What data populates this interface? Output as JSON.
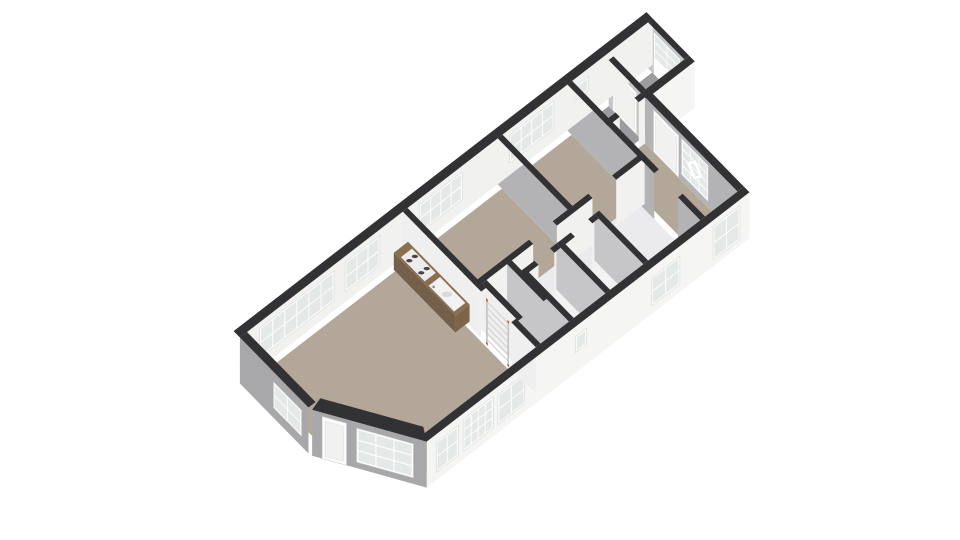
{
  "view": {
    "width": 960,
    "height": 540,
    "background": "#ffffff",
    "kind": "3d-floorplan-render"
  },
  "projection": {
    "origin": [
      247,
      378
    ],
    "axisU": [
      0.791,
      -0.611
    ],
    "axisV": [
      0.7,
      0.714
    ],
    "wallHeight": 46
  },
  "palette": {
    "cap": "#323234",
    "extWhite": "#f5f5f3",
    "intWhite": "#f1f1ef",
    "grayWall": "#b3b3b5",
    "midWall": "#c6c6c8",
    "extGray": "#a8a8aa",
    "lightWall": "#efefef",
    "beigeFloor": "#b3a79a",
    "grayFloor": "#9b9ba0",
    "hallFloor": "#ebebed",
    "whiteFloor": "#f2f2f2",
    "frame": "#fcfcfc",
    "frameEdge": "#cfcfcf",
    "glass": "#e4e8e6",
    "doorFill": "#fbfbfb",
    "doorPanel": "#f1f1ef",
    "counterTop": "#8a6e50",
    "counterWest": "#74604a",
    "counterSouth": "#7d6549",
    "cooktop": "#ececec",
    "burner": "#47474a",
    "sink": "#f2f2f2",
    "sinkBowl": "#d9d9d9",
    "faucet": "#8f8f92",
    "ladderRail": "#c6c6c9",
    "ladderRung": "#d5d5d8",
    "ladderAccent": "#d05a3d"
  },
  "floors": [
    {
      "name": "living-room",
      "color": "beigeFloor",
      "points": [
        [
          6,
          6
        ],
        [
          194,
          6
        ],
        [
          194,
          184
        ],
        [
          60,
          184
        ],
        [
          6,
          98
        ]
      ]
    },
    {
      "name": "bedroom-1",
      "color": "beigeFloor",
      "points": [
        [
          203,
          6
        ],
        [
          317,
          6
        ],
        [
          317,
          100
        ],
        [
          203,
          100
        ]
      ]
    },
    {
      "name": "bedroom-2",
      "color": "beigeFloor",
      "points": [
        [
          323,
          6
        ],
        [
          405,
          6
        ],
        [
          405,
          100
        ],
        [
          323,
          100
        ]
      ]
    },
    {
      "name": "right-room",
      "color": "beigeFloor",
      "points": [
        [
          411,
          58
        ],
        [
          452,
          58
        ],
        [
          452,
          184
        ],
        [
          411,
          184
        ]
      ]
    },
    {
      "name": "hallway",
      "color": "hallFloor",
      "points": [
        [
          203,
          100
        ],
        [
          405,
          100
        ],
        [
          405,
          184
        ],
        [
          203,
          184
        ]
      ]
    },
    {
      "name": "closet",
      "color": "whiteFloor",
      "points": [
        [
          209,
          112
        ],
        [
          235,
          112
        ],
        [
          235,
          158
        ],
        [
          209,
          158
        ]
      ]
    },
    {
      "name": "toilet",
      "color": "whiteFloor",
      "points": [
        [
          245,
          126
        ],
        [
          285,
          126
        ],
        [
          285,
          184
        ],
        [
          245,
          184
        ]
      ]
    },
    {
      "name": "bathroom",
      "color": "whiteFloor",
      "points": [
        [
          291,
          126
        ],
        [
          333,
          126
        ],
        [
          333,
          184
        ],
        [
          291,
          184
        ]
      ]
    },
    {
      "name": "vestibule",
      "color": "grayFloor",
      "points": [
        [
          411,
          6
        ],
        [
          452,
          6
        ],
        [
          452,
          52
        ],
        [
          411,
          52
        ]
      ]
    },
    {
      "name": "porch",
      "color": "grayFloor",
      "points": [
        [
          458,
          6
        ],
        [
          507,
          6
        ],
        [
          507,
          52
        ],
        [
          458,
          52
        ]
      ]
    }
  ],
  "walls": [
    {
      "name": "nw-exterior",
      "rect": [
        -9,
        -9,
        513,
        0
      ],
      "face": "S",
      "color": "intWhite",
      "windows": [
        {
          "s": [
            16,
            110
          ],
          "z": [
            10,
            40
          ],
          "cols": 6,
          "rows": 2,
          "style": "panes"
        },
        {
          "s": [
            124,
            168
          ],
          "z": [
            10,
            40
          ],
          "cols": 3,
          "rows": 2,
          "style": "panes"
        },
        {
          "s": [
            218,
            272
          ],
          "z": [
            12,
            40
          ],
          "cols": 4,
          "rows": 2,
          "style": "panes"
        },
        {
          "s": [
            332,
            388
          ],
          "z": [
            12,
            40
          ],
          "cols": 4,
          "rows": 2,
          "style": "panes"
        },
        {
          "s": [
            416,
            432
          ],
          "z": [
            24,
            38
          ],
          "cols": 1,
          "rows": 1,
          "style": "panes"
        }
      ]
    },
    {
      "name": "sw-exterior",
      "rect": [
        -9,
        0,
        0,
        98
      ],
      "face": "W",
      "color": "extGray",
      "windows": [
        {
          "s": [
            48,
            88
          ],
          "z": [
            10,
            36
          ],
          "cols": 2,
          "rows": 2,
          "style": "panes"
        }
      ]
    },
    {
      "name": "chamfer-bay",
      "cap": [
        [
          6,
          98
        ],
        [
          60,
          184
        ],
        [
          52,
          198
        ],
        [
          -8,
          102
        ]
      ],
      "edge": [
        [
          -8,
          102
        ],
        [
          52,
          198
        ]
      ],
      "color": "extGray",
      "windows": [
        {
          "s": [
            10,
            34
          ],
          "z": [
            0,
            42
          ],
          "style": "door"
        },
        {
          "s": [
            44,
            100
          ],
          "z": [
            6,
            40
          ],
          "cols": 3,
          "rows": 3,
          "style": "panes"
        }
      ]
    },
    {
      "name": "se-exterior",
      "rect": [
        52,
        190,
        460,
        198
      ],
      "face": "S",
      "color": "extWhite",
      "windows": [
        {
          "s": [
            64,
            92
          ],
          "z": [
            8,
            38
          ],
          "cols": 2,
          "rows": 2,
          "style": "panes"
        },
        {
          "s": [
            98,
            136
          ],
          "z": [
            8,
            40
          ],
          "cols": 4,
          "rows": 3,
          "style": "panes"
        },
        {
          "s": [
            142,
            176
          ],
          "z": [
            8,
            38
          ],
          "cols": 2,
          "rows": 2,
          "style": "panes"
        },
        {
          "s": [
            240,
            254
          ],
          "z": [
            20,
            36
          ],
          "cols": 1,
          "rows": 1,
          "style": "panes"
        },
        {
          "s": [
            336,
            372
          ],
          "z": [
            8,
            36
          ],
          "cols": 2,
          "rows": 2,
          "style": "panes"
        },
        {
          "s": [
            414,
            448
          ],
          "z": [
            6,
            40
          ],
          "cols": 2,
          "rows": 2,
          "style": "panes"
        }
      ]
    },
    {
      "name": "front-entry-wall",
      "rect": [
        452,
        58,
        460,
        190
      ],
      "face": "W",
      "color": "grayWall",
      "windows": [
        {
          "s": [
            70,
            106
          ],
          "z": [
            0,
            42
          ],
          "style": "door"
        },
        {
          "s": [
            110,
            148
          ],
          "z": [
            6,
            42
          ],
          "cols": 3,
          "rows": 4,
          "style": "panes",
          "diamond": true
        }
      ]
    },
    {
      "name": "porch-south",
      "rect": [
        452,
        52,
        513,
        60
      ],
      "face": "S",
      "color": "extWhite",
      "windows": []
    },
    {
      "name": "porch-divider",
      "rect": [
        452,
        6,
        458,
        52
      ],
      "face": "W",
      "color": "midWall",
      "windows": [
        {
          "s": [
            12,
            46
          ],
          "z": [
            0,
            42
          ],
          "style": "door"
        }
      ]
    },
    {
      "name": "porch-east",
      "rect": [
        507,
        0,
        513,
        52
      ],
      "face": "W",
      "color": "midWall",
      "windows": [
        {
          "s": [
            8,
            46
          ],
          "z": [
            0,
            42
          ],
          "cols": 2,
          "rows": 3,
          "style": "glazed-door"
        }
      ]
    },
    {
      "name": "kitchen-wall-n",
      "rect": [
        197,
        0,
        203,
        112
      ],
      "face": "W",
      "color": "lightWall",
      "windows": []
    },
    {
      "name": "kitchen-wall-s",
      "rect": [
        197,
        155,
        203,
        190
      ],
      "face": "W",
      "color": "lightWall",
      "windows": []
    },
    {
      "name": "closet-west",
      "rect": [
        203,
        106,
        209,
        158
      ],
      "face": "W",
      "color": "lightWall",
      "windows": []
    },
    {
      "name": "bed-south-1",
      "rect": [
        197,
        100,
        268,
        106
      ],
      "face": "S",
      "color": "intWhite",
      "windows": []
    },
    {
      "name": "bed-south-2",
      "rect": [
        298,
        100,
        343,
        106
      ],
      "face": "S",
      "color": "intWhite",
      "windows": []
    },
    {
      "name": "bed-south-3",
      "rect": [
        373,
        100,
        409,
        106
      ],
      "face": "S",
      "color": "intWhite",
      "windows": []
    },
    {
      "name": "bed-divider",
      "rect": [
        317,
        0,
        323,
        100
      ],
      "face": "W",
      "color": "grayWall",
      "windows": []
    },
    {
      "name": "hall-east-n",
      "rect": [
        405,
        0,
        411,
        124
      ],
      "face": "W",
      "color": "grayWall",
      "windows": []
    },
    {
      "name": "hall-east-s",
      "rect": [
        405,
        158,
        411,
        190
      ],
      "face": "W",
      "color": "grayWall",
      "windows": []
    },
    {
      "name": "vest-div-a",
      "rect": [
        405,
        52,
        420,
        58
      ],
      "face": "S",
      "color": "intWhite",
      "windows": []
    },
    {
      "name": "vest-div-b",
      "rect": [
        444,
        52,
        452,
        58
      ],
      "face": "S",
      "color": "intWhite",
      "windows": []
    },
    {
      "name": "closet-east",
      "rect": [
        235,
        106,
        241,
        158
      ],
      "face": "W",
      "color": "midWall",
      "windows": []
    },
    {
      "name": "toilet-west",
      "rect": [
        239,
        120,
        245,
        190
      ],
      "face": "W",
      "color": "midWall",
      "windows": []
    },
    {
      "name": "toilet-north-a",
      "rect": [
        239,
        120,
        257,
        126
      ],
      "face": "S",
      "color": "intWhite",
      "windows": []
    },
    {
      "name": "toilet-north-b",
      "rect": [
        277,
        120,
        285,
        126
      ],
      "face": "S",
      "color": "intWhite",
      "windows": []
    },
    {
      "name": "toilet-bath-div",
      "rect": [
        285,
        120,
        291,
        190
      ],
      "face": "W",
      "color": "midWall",
      "windows": []
    },
    {
      "name": "bath-north-a",
      "rect": [
        291,
        120,
        303,
        126
      ],
      "face": "S",
      "color": "intWhite",
      "windows": []
    },
    {
      "name": "bath-north-b",
      "rect": [
        325,
        120,
        333,
        126
      ],
      "face": "S",
      "color": "intWhite",
      "windows": []
    },
    {
      "name": "bath-east",
      "rect": [
        333,
        120,
        339,
        190
      ],
      "face": "W",
      "color": "midWall",
      "windows": []
    }
  ],
  "kitchen": {
    "counter": {
      "rect": [
        182,
        4,
        200,
        92
      ],
      "height": 17
    },
    "cooktop": {
      "rect": [
        184,
        12,
        198,
        46
      ]
    },
    "burners": [
      [
        187.5,
        20
      ],
      [
        194.5,
        20
      ],
      [
        187.5,
        37
      ],
      [
        194.5,
        37
      ]
    ],
    "sink": {
      "rect": [
        184,
        52,
        198,
        88
      ],
      "bowl": [
        191,
        70
      ],
      "faucet": [
        185.5,
        57
      ]
    }
  },
  "ladder": {
    "u": 196,
    "v1": 120,
    "v2": 150.5,
    "railWidth": 2.5,
    "height": 46,
    "rungs": 7
  }
}
